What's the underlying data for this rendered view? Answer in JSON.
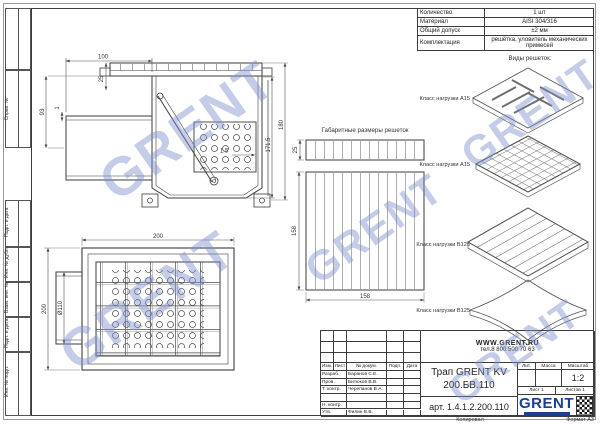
{
  "frame": {
    "copied": "Копировал",
    "format": "Формат А3",
    "strip_labels": [
      "Справ. №",
      "Подп. и дата",
      "Инв. № дубл.",
      "Взам. инв. №",
      "Подп. и дата",
      "Инв. № подл."
    ]
  },
  "spec": {
    "rows": [
      {
        "label": "Количество",
        "value": "1 шт"
      },
      {
        "label": "Материал",
        "value": "AISI 304/316"
      },
      {
        "label": "Общий допуск",
        "value": "±2 мм"
      },
      {
        "label": "Комплектация",
        "value": "решётка, уловитель механических примесей"
      }
    ]
  },
  "views": {
    "grates_panel_title": "Виды решеток:",
    "grate_labels": [
      "Класс нагрузки А15",
      "Класс нагрузки А15",
      "Класс нагрузки В125",
      "Класс нагрузки В125"
    ],
    "overall_title": "Габаритные размеры решеток",
    "dims": {
      "side": {
        "top_width": "100",
        "grate_h": "25",
        "left_h": "93",
        "gap": "1",
        "wall": "1.5",
        "inner_h": "171.5",
        "outer_h": "180"
      },
      "plan": {
        "width": "200",
        "height": "200",
        "pipe": "Ø110"
      },
      "grate": {
        "h": "25",
        "w": "158",
        "d": "158"
      }
    }
  },
  "title_block": {
    "website": "WWW.GRENT.RU",
    "phone": "тел.8 800 500 70 63",
    "header_cols": [
      "Изм.",
      "Лист",
      "№ докум.",
      "Подп.",
      "Дата"
    ],
    "sign_rows": [
      {
        "role": "Разраб.",
        "name": "Баранов С.Е."
      },
      {
        "role": "Пров.",
        "name": "Битюков В.В."
      },
      {
        "role": "Т. контр.",
        "name": "Черепанов В.А."
      },
      {
        "role": "",
        "name": ""
      },
      {
        "role": "Н. контр.",
        "name": ""
      },
      {
        "role": "Утв.",
        "name": "Филин В.В."
      }
    ],
    "doc_title_line1": "Трап GRENT KV",
    "doc_title_line2": "200.БВ.110",
    "article": "арт. 1.4.1.2.200.110",
    "lit_label": "Лит.",
    "mass_label": "Масса",
    "scale_label": "Масштаб",
    "scale": "1:2",
    "sheet": "Лист 1",
    "sheets": "Листов 1",
    "logo": "GRENT"
  },
  "watermark": {
    "text": "GRENT",
    "color": "#7d8fc9"
  },
  "colors": {
    "line": "#3c3c3c",
    "accent": "#1d3d91"
  }
}
